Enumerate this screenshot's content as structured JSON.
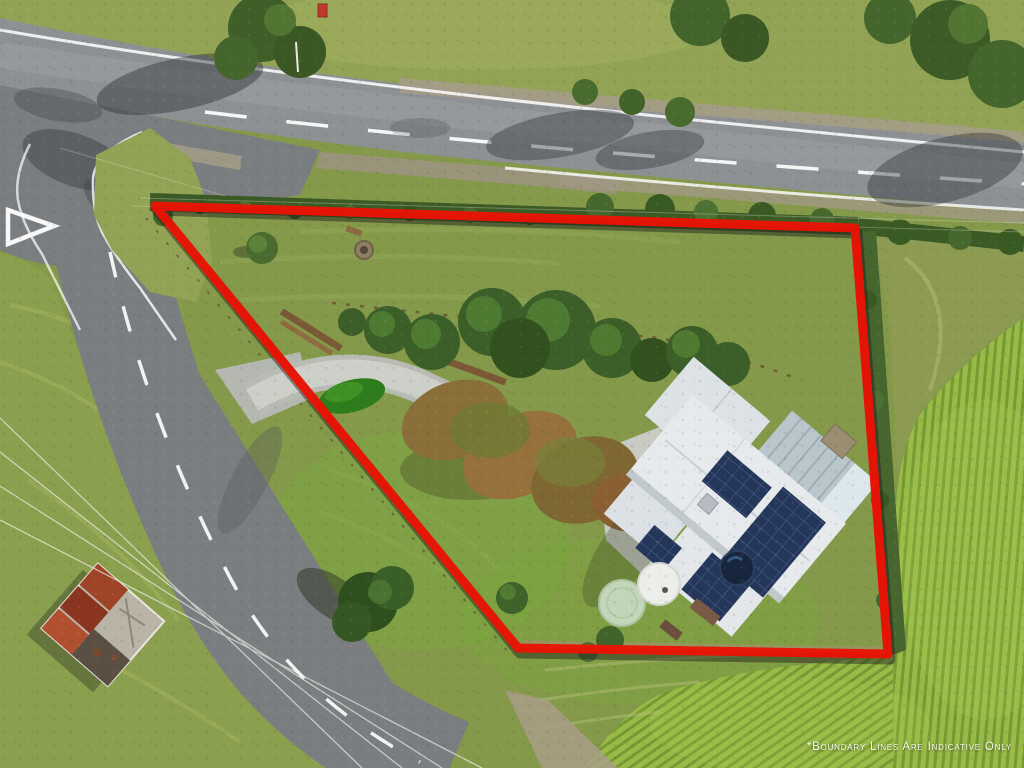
{
  "watermark": {
    "text": "*Boundary Lines Are Indicative Only"
  },
  "colors": {
    "boundary_red": "#e91405",
    "road_asphalt": "#8e9194",
    "side_road": "#7b7e80",
    "lawn_green": "#84994a",
    "bank_green": "#93a355",
    "field_left": "#8aa04e",
    "corn_green": "#9aba48",
    "corn_row": "#6d9431",
    "hedge_green": "#3b5a25",
    "canopy_brown": "#8a6f3a",
    "roof_white": "#e7eaec",
    "solar_blue": "#243659",
    "concrete_gray": "#c8cac3",
    "tank_green": "#c2d6ba",
    "tank_white": "#eceee9",
    "spa_navy": "#17263d",
    "shed_rust": "#a04427",
    "marking_white": "#ffffff",
    "watermark_white": "#ffffff"
  }
}
